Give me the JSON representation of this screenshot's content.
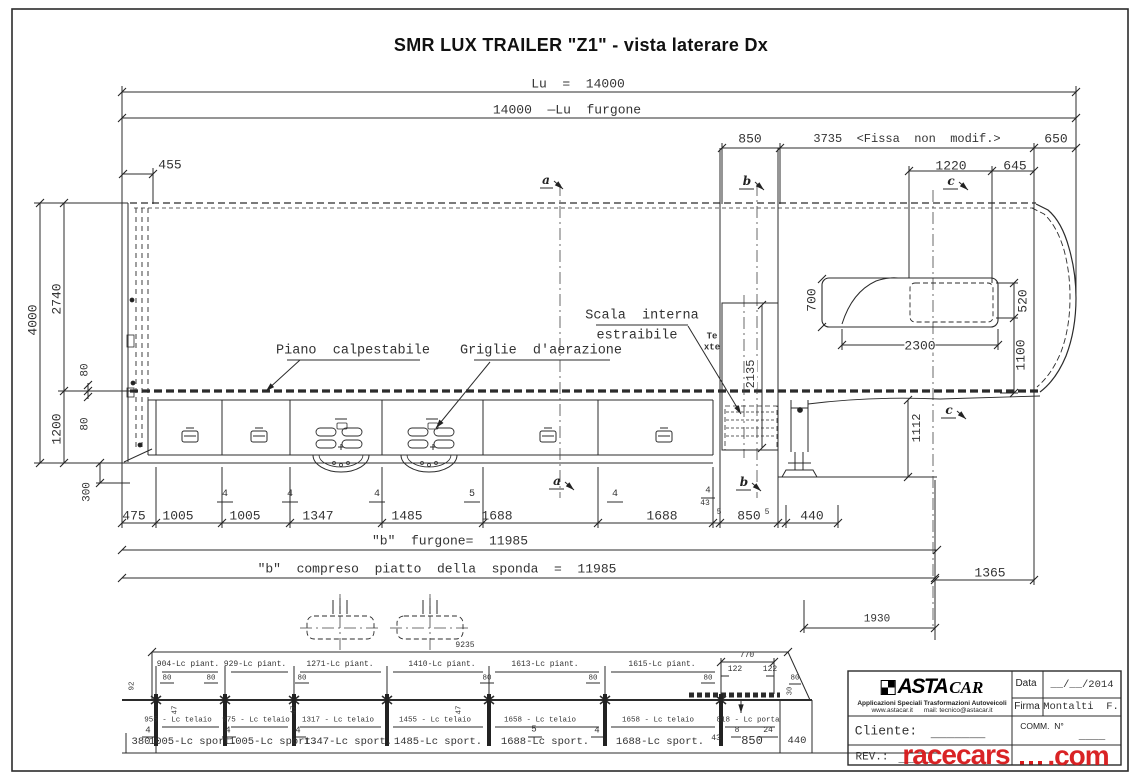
{
  "title": "SMR LUX TRAILER \"Z1\" - vista laterare Dx",
  "dims": {
    "lu": "Lu  =  14000",
    "lu_furgone": "14000  —Lu  furgone",
    "rear_850": "850",
    "fissa": "3735  <Fissa  non  modif.>",
    "front_650": "650",
    "win_1220": "1220",
    "win_645": "645",
    "rear_455": "455",
    "h4000": "4000",
    "h2740": "2740",
    "h80a": "80",
    "h1200": "1200",
    "h80b": "80",
    "h300": "300",
    "door_2135": "2135",
    "gn_700": "700",
    "gn_2300": "2300",
    "gn_520": "520",
    "gn_1100": "1100",
    "leg_1112": "1112",
    "chain": [
      "475",
      "1005",
      "1005",
      "1347",
      "1485",
      "1688",
      "1688",
      "850",
      "440"
    ],
    "gap4": "4",
    "gap5": "5",
    "gap43": "43",
    "b_furgone": "\"b\"  furgone=  11985",
    "b_sponda": "\"b\"  compreso  piatto  della  sponda  =  11985",
    "d1365": "1365",
    "d1930": "1930"
  },
  "callouts": {
    "piano": "Piano  calpestabile",
    "griglie": "Griglie  d'aerazione",
    "scala1": "Scala  interna",
    "scala2": "estraibile",
    "te": "Te",
    "xte": "xte"
  },
  "sections": {
    "a": "a",
    "b": "b",
    "c": "c"
  },
  "schematic": {
    "d9235": "9235",
    "piant": [
      "904-Lc piant.",
      "929-Lc piant.",
      "1271-Lc piant.",
      "1410-Lc piant.",
      "1613-Lc piant.",
      "1615-Lc piant."
    ],
    "d80": "80",
    "d92": "92",
    "d47": "47",
    "d30": "30",
    "telaio": [
      "955 - Lc telaio",
      "975 - Lc telaio",
      "1317 - Lc telaio",
      "1455 - Lc telaio",
      "1658 - Lc telaio",
      "1658 - Lc telaio"
    ],
    "porta": "818 - Lc porta",
    "sport": [
      "1005-Lc sport.",
      "1005-Lc sport.",
      "1347-Lc sport.",
      "1485-Lc sport.",
      "1688-Lc sport.",
      "1688-Lc sport."
    ],
    "d380": "380",
    "d850": "850",
    "d440": "440",
    "d770": "770",
    "d122a": "122",
    "d122b": "122",
    "g4": "4",
    "g5": "5",
    "d8": "8",
    "d24": "24",
    "d43": "43"
  },
  "title_block": {
    "logo_asta": "ASTA",
    "logo_car": "CAR",
    "tagline": "Applicazioni Speciali Trasformazioni Autoveicoli",
    "contacts": "www.astacar.it      mail: tecnico@astacar.it",
    "data_label": "Data",
    "data_value": "__/__/2014",
    "firma_label": "Firma",
    "firma_value": "Montalti  F.",
    "cliente_label": "Cliente:",
    "cliente_value": "_______",
    "comm_label": "COMM.  N°",
    "comm_value": "____",
    "rev_label": "REV.:",
    "rev_value": "_____",
    "watermark_a": "racecars",
    "watermark_b": ".com"
  }
}
